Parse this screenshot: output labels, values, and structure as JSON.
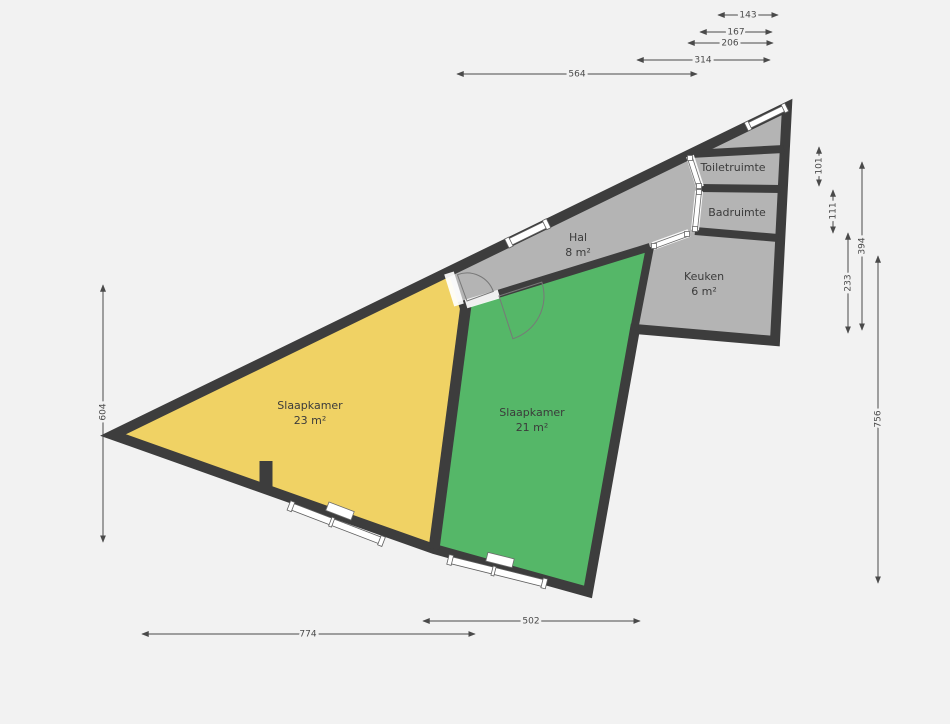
{
  "colors": {
    "background": "#f2f2f2",
    "wall": "#3d3d3d",
    "room_gray": "#b4b4b4",
    "room_yellow": "#f0d264",
    "room_green": "#55b768",
    "dimension": "#4a4a4a",
    "window": "#ffffff"
  },
  "rooms": {
    "hal": {
      "name": "Hal",
      "area": "8 m²"
    },
    "toiletruimte": {
      "name": "Toiletruimte"
    },
    "badruimte": {
      "name": "Badruimte"
    },
    "keuken": {
      "name": "Keuken",
      "area": "6 m²"
    },
    "slaapkamer_links": {
      "name": "Slaapkamer",
      "area": "23 m²"
    },
    "slaapkamer_rechts": {
      "name": "Slaapkamer",
      "area": "21 m²"
    }
  },
  "dimensions": {
    "top": {
      "d143": "143",
      "d167": "167",
      "d206": "206",
      "d314": "314",
      "d564": "564"
    },
    "right": {
      "d101": "101",
      "d111": "111",
      "d394": "394",
      "d233": "233",
      "d756": "756"
    },
    "left": {
      "d604": "604"
    },
    "bottom": {
      "d502": "502",
      "d774": "774"
    }
  }
}
